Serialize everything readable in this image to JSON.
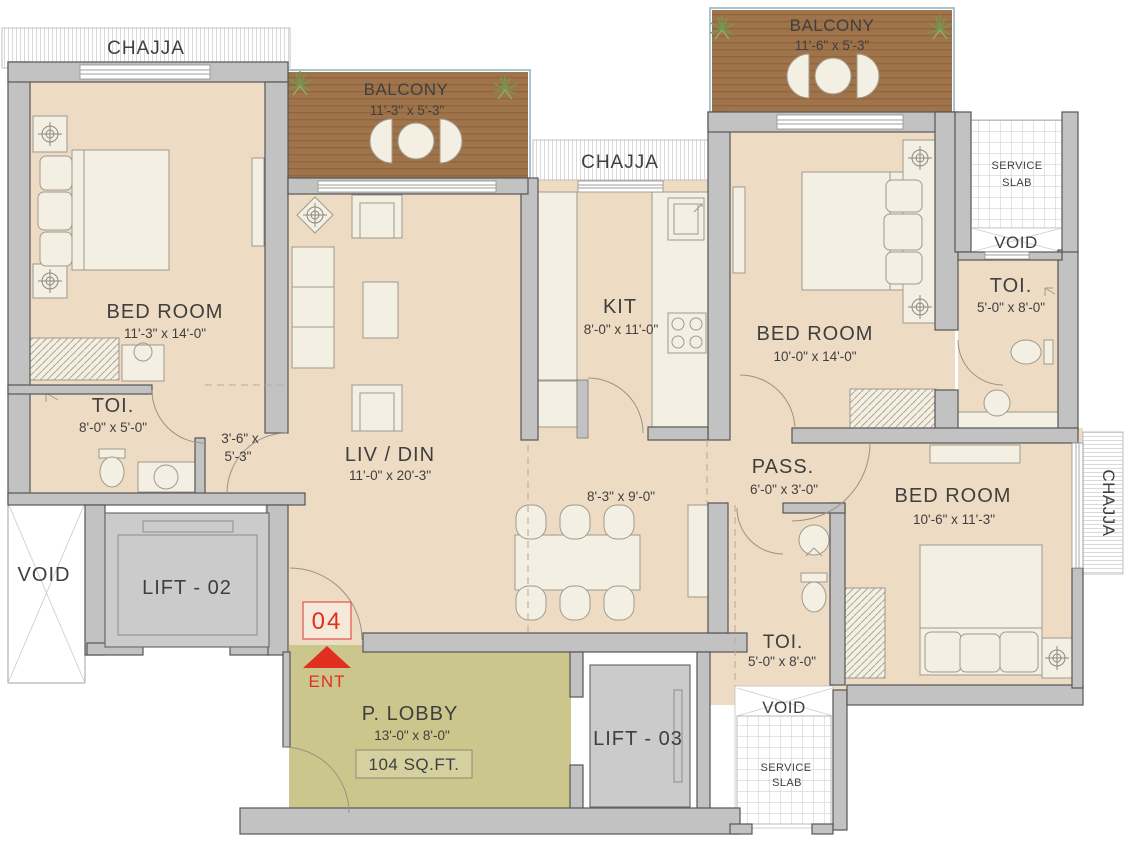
{
  "colors": {
    "room-fill": "#eedbc3",
    "lobby-fill": "#cbc68c",
    "balcony-wood": "#a0744a",
    "balcony-wood-dark": "#8f6640",
    "wall-fill": "#c2c2c2",
    "wall-stroke": "#565656",
    "lift-fill": "#cbcbcb",
    "furniture-fill": "#f3efe3",
    "furniture-stroke": "#a09a8c",
    "accent-red": "#e12f1f",
    "text-color": "#3f3f3f",
    "dash-color": "#bfae92",
    "plant-green": "#6f9c4f"
  },
  "labels": {
    "chajja_top": "CHAJJA",
    "chajja_mid": "CHAJJA",
    "chajja_right": "CHAJJA",
    "balcony_left": {
      "name": "BALCONY",
      "dims": "11'-3\" x 5'-3\""
    },
    "balcony_right": {
      "name": "BALCONY",
      "dims": "11'-6\" x 5'-3\""
    },
    "bedroom_left": {
      "name": "BED ROOM",
      "dims": "11'-3\" x 14'-0\""
    },
    "toi_left": {
      "name": "TOI.",
      "dims": "8'-0\" x 5'-0\""
    },
    "passage": {
      "line1": "3'-6\" x",
      "line2": "5'-3\""
    },
    "livdin": {
      "name": "LIV / DIN",
      "dims": "11'-0\" x 20'-3\""
    },
    "dining": {
      "dims": "8'-3\" x 9'-0\""
    },
    "kitchen": {
      "name": "KIT",
      "dims": "8'-0\" x 11'-0\""
    },
    "bedroom_right": {
      "name": "BED ROOM",
      "dims": "10'-0\" x 14'-0\""
    },
    "toi_right": {
      "name": "TOI.",
      "dims": "5'-0\" x 8'-0\""
    },
    "pass": {
      "name": "PASS.",
      "dims": "6'-0\" x 3'-0\""
    },
    "bedroom_bottom": {
      "name": "BED ROOM",
      "dims": "10'-6\" x 11'-3\""
    },
    "toi_bottom": {
      "name": "TOI.",
      "dims": "5'-0\" x 8'-0\""
    },
    "plobby": {
      "name": "P. LOBBY",
      "dims": "13'-0\" x 8'-0\"",
      "area": "104 SQ.FT."
    },
    "service_top": {
      "line1": "SERVICE",
      "line2": "SLAB"
    },
    "service_bottom": {
      "line1": "SERVICE",
      "line2": "SLAB"
    },
    "void_left": "VOID",
    "void_top_right": "VOID",
    "void_bottom_right": "VOID",
    "lift02": "LIFT - 02",
    "lift03": "LIFT - 03",
    "entry": {
      "unit": "04",
      "label": "ENT"
    }
  }
}
